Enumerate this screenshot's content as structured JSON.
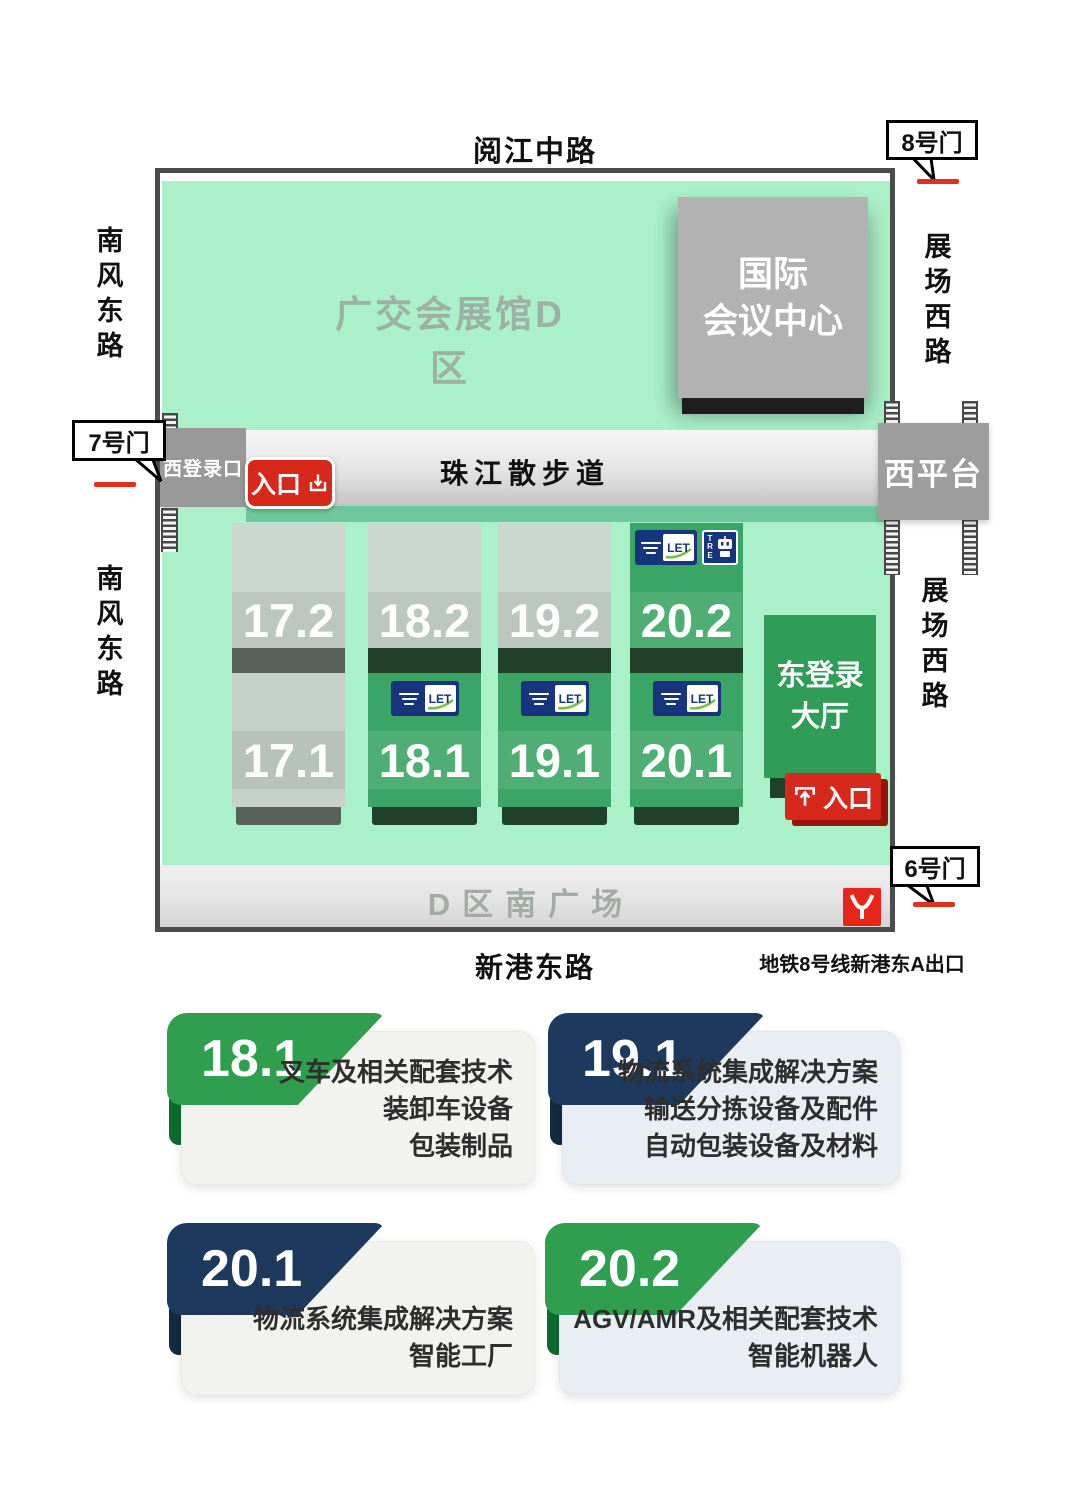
{
  "map": {
    "roads": {
      "top": "阅江中路",
      "left": "南风东路",
      "right": "展场西路",
      "bottom": "新港东路"
    },
    "gates": {
      "g7": "7号门",
      "g8": "8号门",
      "g6": "6号门"
    },
    "area_label": "广交会展馆D区",
    "convention_center_line1": "国际",
    "convention_center_line2": "会议中心",
    "promenade": "珠江散步道",
    "west_checkin": "西登录口",
    "west_platform": "西平台",
    "entrance": "入口",
    "east_hall_line1": "东登录",
    "east_hall_line2": "大厅",
    "south_square": "D区南广场",
    "metro_exit": "地铁8号线新港东A出口",
    "columns": [
      {
        "top": "17.2",
        "bottom": "17.1"
      },
      {
        "top": "18.2",
        "bottom": "18.1"
      },
      {
        "top": "19.2",
        "bottom": "19.1"
      },
      {
        "top": "20.2",
        "bottom": "20.1"
      }
    ],
    "logos": {
      "let": "LET",
      "tre": "TRE"
    }
  },
  "legend": [
    {
      "number": "18.1",
      "ribbon": "green",
      "lines": [
        "叉车及相关配套技术",
        "装卸车设备",
        "包装制品"
      ]
    },
    {
      "number": "19.1",
      "ribbon": "navy",
      "lines": [
        "物流系统集成解决方案",
        "输送分拣设备及配件",
        "自动包装设备及材料"
      ]
    },
    {
      "number": "20.1",
      "ribbon": "navy",
      "lines": [
        "物流系统集成解决方案",
        "智能工厂"
      ]
    },
    {
      "number": "20.2",
      "ribbon": "green",
      "lines": [
        "AGV/AMR及相关配套技术",
        "智能机器人"
      ]
    }
  ],
  "colors": {
    "mint": "#aaf0c8",
    "hall_green": "#3aa565",
    "hall_gray": "#ccd8cf",
    "accent_red": "#d7281c",
    "ribbon_green": "#2f9e4f",
    "ribbon_navy": "#1d3a5e",
    "logo_navy": "#16357d"
  }
}
